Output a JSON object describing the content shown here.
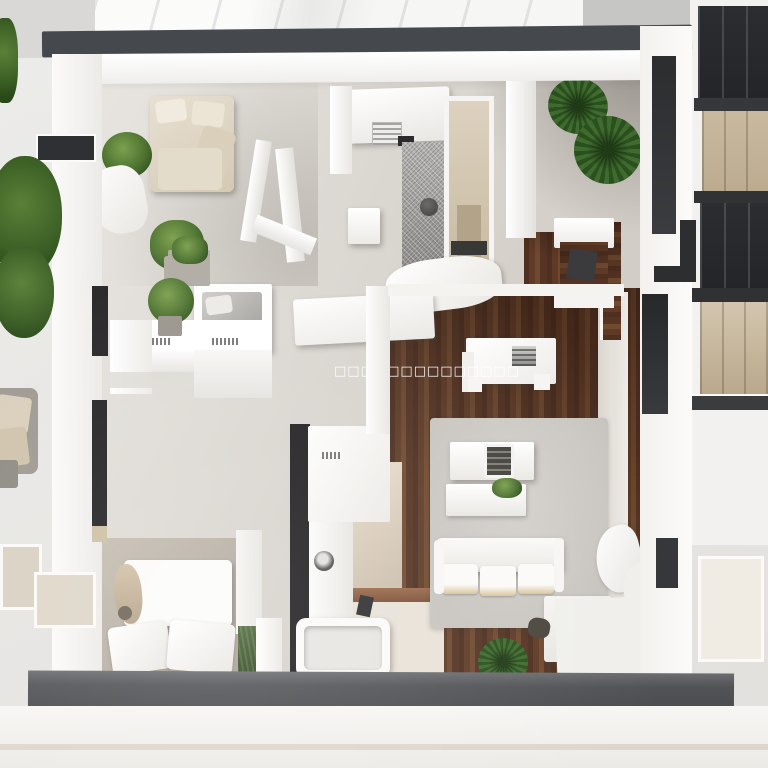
{
  "scene": {
    "glyph_row": "□□□□□□□□□□□□□□"
  },
  "palette": {
    "wall_white": "#f7f6f4",
    "top_wall_dark": "#45484c",
    "bottom_wall_dark": "#515356",
    "interior_floor": "#d9d5cf",
    "wood_floor": "#5d3a27",
    "rug": "#c8c5c0",
    "plant_green": "#47682e",
    "accent_black": "#1f1f21",
    "furniture_beige": "#d5c9b4",
    "building_glass": "#2b2d30",
    "building_panel": "#c9ba9f"
  }
}
